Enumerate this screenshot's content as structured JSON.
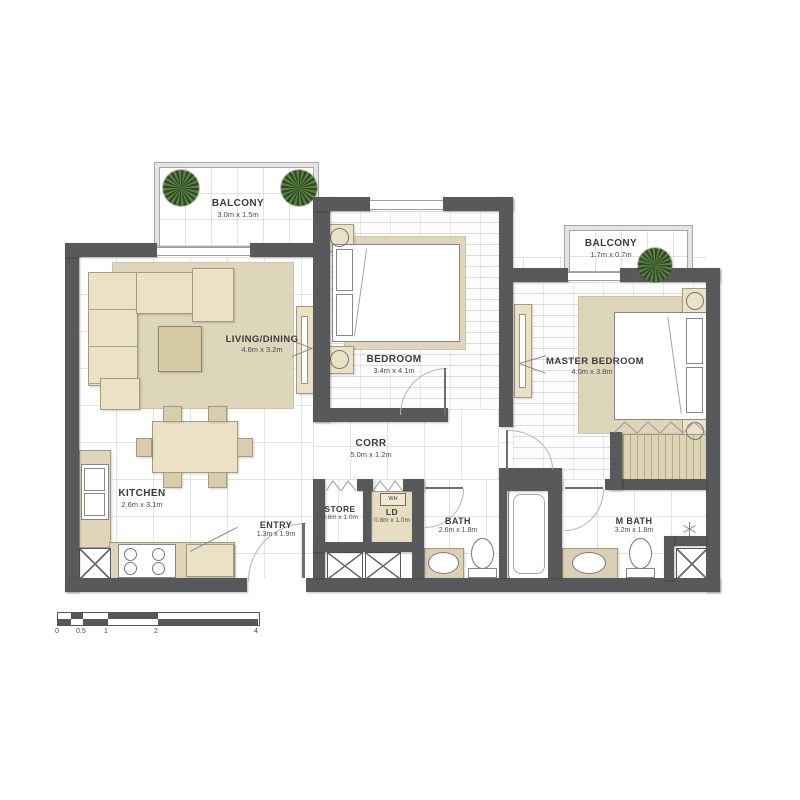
{
  "rooms": {
    "balcony_top": {
      "name": "BALCONY",
      "dims": "3.0m x 1.5m"
    },
    "balcony_side": {
      "name": "BALCONY",
      "dims": "1.7m x 0.7m"
    },
    "living": {
      "name": "LIVING/DINING",
      "dims": "4.6m x 3.2m"
    },
    "bedroom": {
      "name": "BEDROOM",
      "dims": "3.4m x 4.1m"
    },
    "master": {
      "name": "MASTER BEDROOM",
      "dims": "4.0m x 3.8m"
    },
    "corridor": {
      "name": "CORR",
      "dims": "5.0m x 1.2m"
    },
    "kitchen": {
      "name": "KITCHEN",
      "dims": "2.6m x 3.1m"
    },
    "entry": {
      "name": "ENTRY",
      "dims": "1.3m x 1.9m"
    },
    "store": {
      "name": "STORE",
      "dims": "0.8m x 1.0m"
    },
    "laundry": {
      "name": "LD",
      "dims": "0.8m x 1.0m",
      "tag": "WH"
    },
    "bath": {
      "name": "BATH",
      "dims": "2.6m x 1.8m"
    },
    "master_bath": {
      "name": "M BATH",
      "dims": "3.2m x 1.8m"
    }
  },
  "scale_bar": {
    "ticks": [
      "0",
      "0.5",
      "1",
      "2",
      "4"
    ]
  },
  "colors": {
    "wall": "#58595b",
    "furniture": "#ebe2c6",
    "rug": "#ddd6ba",
    "plant": "#2c4a20",
    "floor_line": "#cbd0d4",
    "label": "#3a3b3d"
  }
}
